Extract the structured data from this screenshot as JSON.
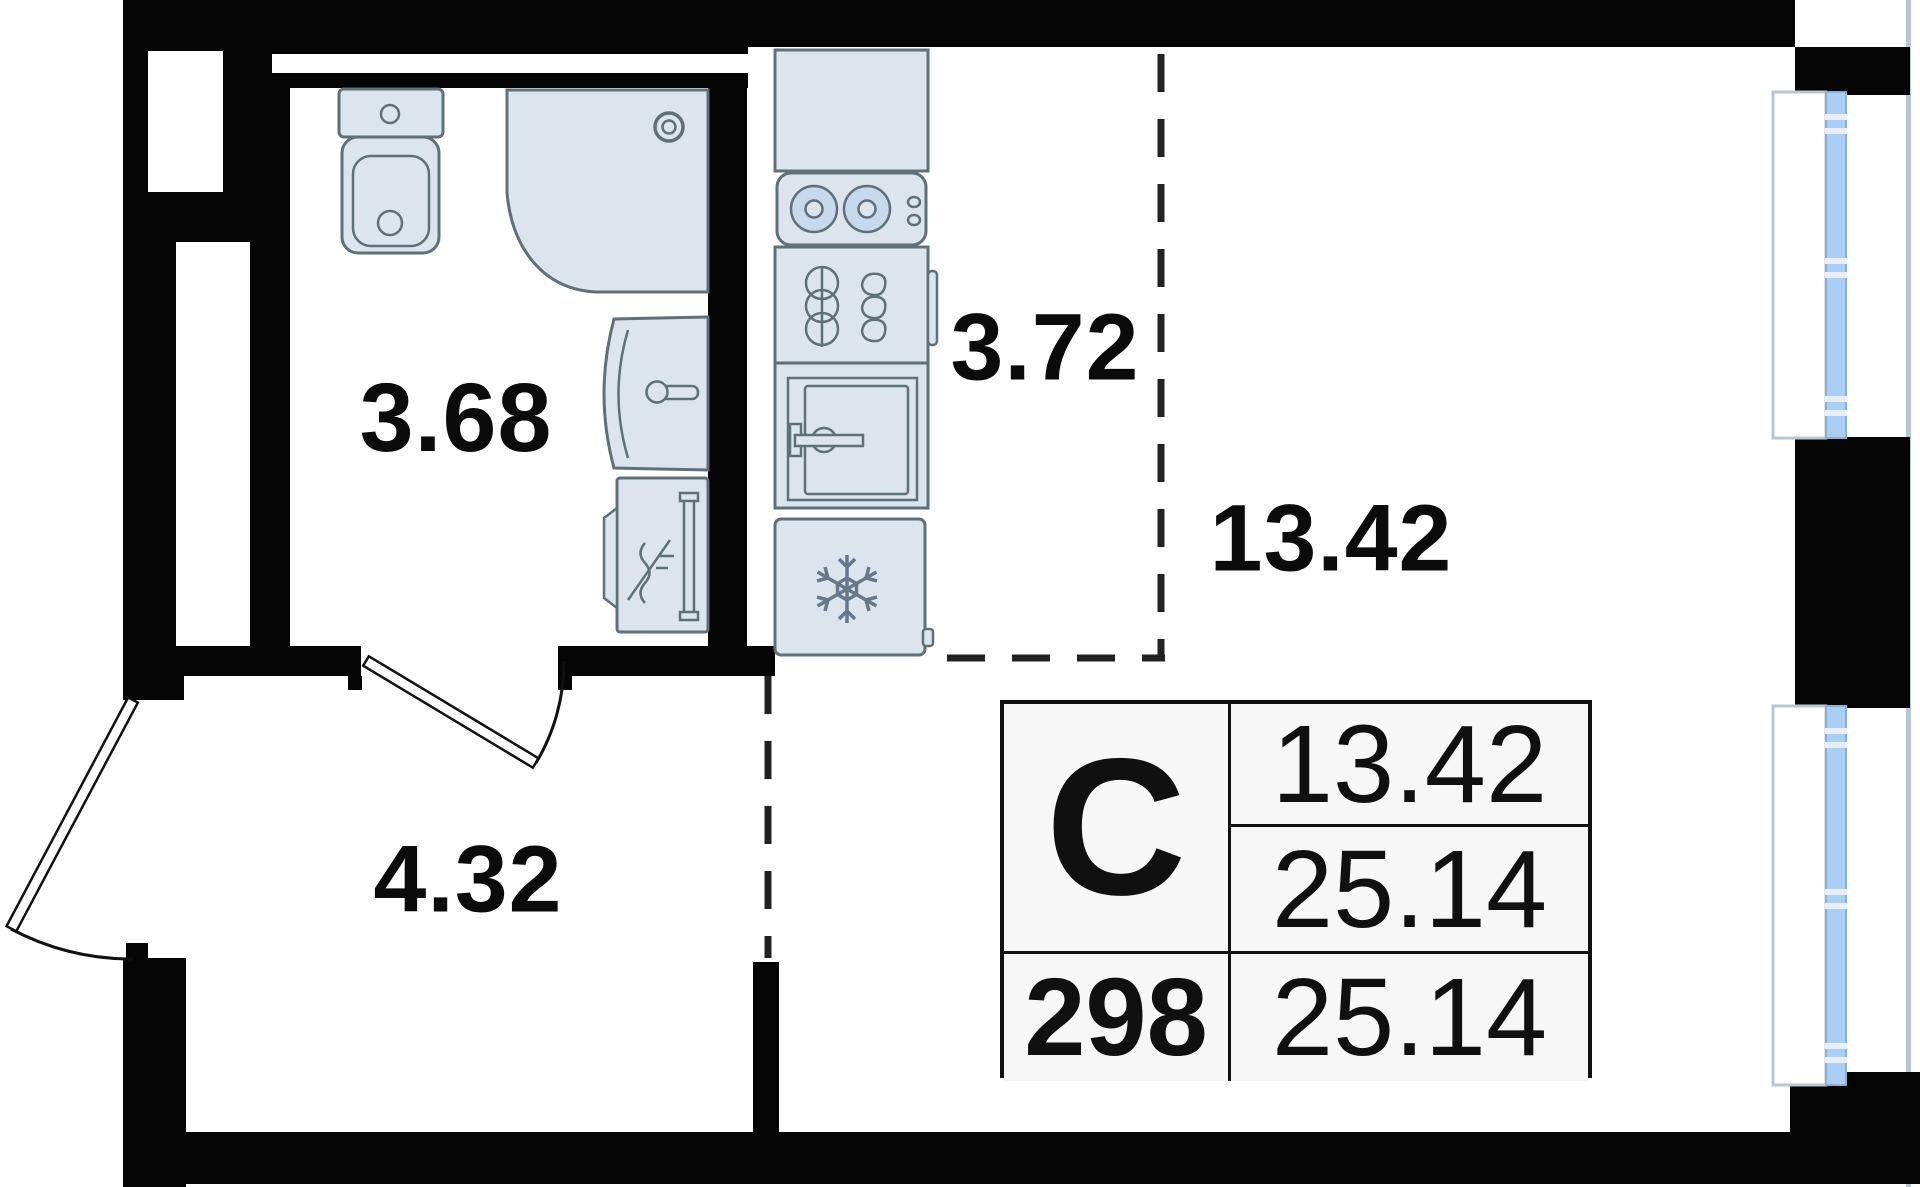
{
  "floorplan": {
    "room_labels": {
      "bathroom_area": "3.68",
      "kitchen_area": "3.72",
      "living_area": "13.42",
      "hall_area": "4.32"
    },
    "info_table": {
      "type_letter": "С",
      "living_area": "13.42",
      "total_area": "25.14",
      "unit_number": "298",
      "total_area_repeat": "25.14"
    },
    "icons": [
      "snowflake-icon",
      "stove-burners-icon",
      "oven-icon",
      "kitchen-rack-icon",
      "bathtub-icon",
      "toilet-icon",
      "sink-icon",
      "washing-machine-icon",
      "window-glazing-icon",
      "door-swing-arc-icon"
    ],
    "colors": {
      "wall": "#050505",
      "fixture-fill": "#dce4ed",
      "fixture-stroke": "#5f7078",
      "burner-fill": "#c7d9ed",
      "glazing-fill": "#a9d0f4",
      "sill-stroke": "#b9c7d3",
      "table-bg": "#f7f7f8",
      "label": "#0b0b0b"
    }
  }
}
